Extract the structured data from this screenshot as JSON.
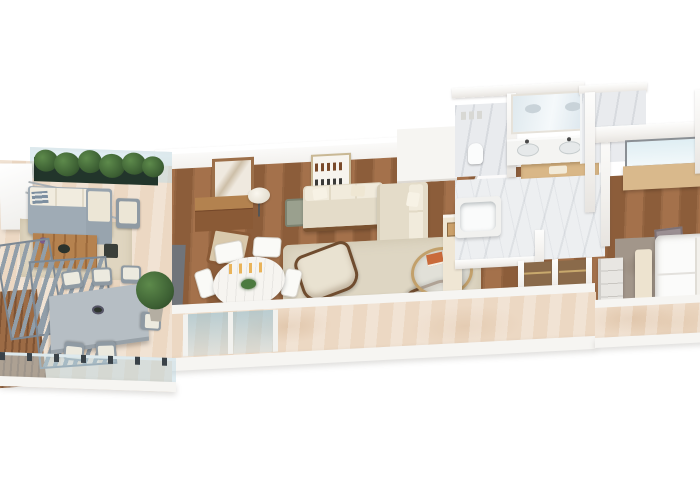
{
  "meta": {
    "title": "3D apartment floor plan render",
    "view": "isometric cutaway, white background",
    "background": "#ffffff"
  },
  "palette": {
    "background": "#ffffff",
    "wall_white": "#f6f5f2",
    "wood_floor": "#9a6847",
    "travertine_terrace": "#ecd8c3",
    "marble_bathroom": "#edeff1",
    "sofa_cream": "#e9e2d1",
    "outdoor_gray": "#8f9aa3",
    "plant_green": "#3c5f33",
    "glass_blue": "#bcd8e4",
    "wood_furniture": "#9c6a42",
    "brass_rail": "#c8a96d",
    "rug_beige": "#ded6c3",
    "rug_gray": "#a2968a"
  },
  "rooms": [
    {
      "id": "terrace-lounge",
      "label": "Outdoor terrace lounge",
      "furniture": [
        "white-canopy",
        "planter-hedge",
        "glass-railing",
        "outdoor-sofa",
        "outdoor-lounge-chair",
        "wood-coffee-table",
        "outdoor-rug",
        "pergola-slats",
        "outdoor-dining-table",
        "outdoor-dining-chairs",
        "potted-plant",
        "glass-balustrade"
      ]
    },
    {
      "id": "living-room",
      "label": "Living and dining room",
      "furniture": [
        "desk",
        "wall-mirror",
        "table-lamp",
        "desk-chair",
        "bar-shelf",
        "side-chair",
        "sectional-sofa",
        "throw-pillows",
        "shag-rug",
        "glass-coffee-table",
        "book",
        "accent-chair-left",
        "accent-chair-right",
        "round-dining-table",
        "candles",
        "centerpiece-plant",
        "dining-chairs",
        "sliding-glass-door"
      ]
    },
    {
      "id": "hallway",
      "label": "Hallway",
      "furniture": [
        "console-cabinet",
        "framed-art",
        "open-door"
      ]
    },
    {
      "id": "bathroom",
      "label": "Master bathroom",
      "furniture": [
        "double-vanity",
        "vanity-sinks",
        "vanity-mirror",
        "wooden-shelf",
        "bathtub",
        "toilet",
        "water-closet",
        "shower-room"
      ]
    },
    {
      "id": "walk-in-closet",
      "label": "Walk-in closet",
      "furniture": [
        "hanging-rails",
        "partitions"
      ]
    },
    {
      "id": "bedroom",
      "label": "Bedroom",
      "furniture": [
        "bed",
        "pillows",
        "foot-bench",
        "dresser",
        "gray-rug",
        "desk-nook",
        "window",
        "stool"
      ]
    },
    {
      "id": "front-terrace",
      "label": "Front balcony terrace",
      "furniture": [
        "parapet-wall",
        "glass-door-reflections"
      ]
    }
  ]
}
